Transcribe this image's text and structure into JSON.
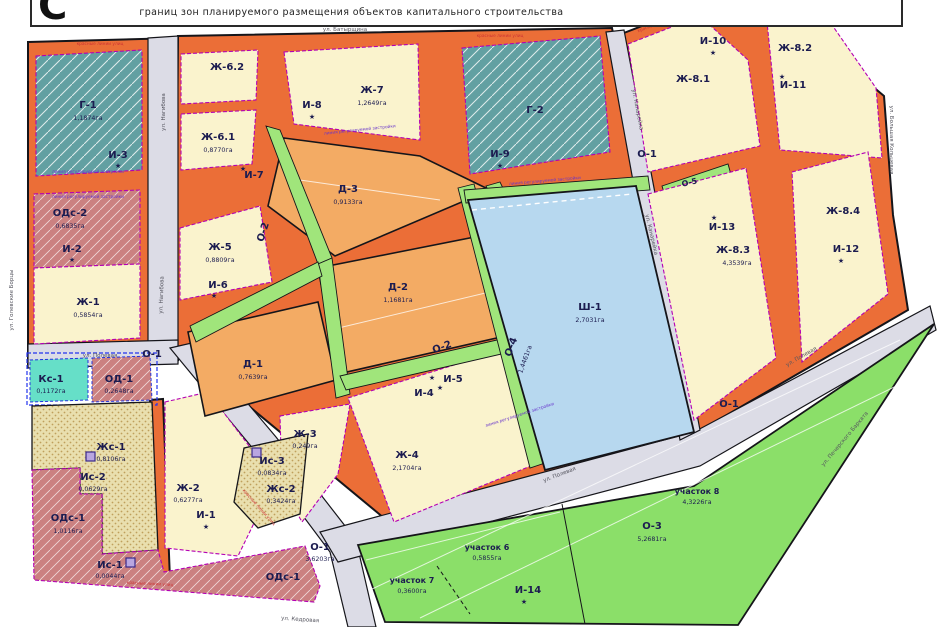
{
  "header": {
    "glyph": "С",
    "title": "границ зон планируемого размещения объектов капитального строительства"
  },
  "icons": {
    "star": "★"
  },
  "zones": {
    "g1": {
      "name": "Г-1",
      "area": "1,1874га"
    },
    "g2": {
      "name": "Г-2"
    },
    "i1": {
      "name": "И-1"
    },
    "i2": {
      "name": "И-2"
    },
    "i3": {
      "name": "И-3"
    },
    "i4": {
      "name": "И-4"
    },
    "i5": {
      "name": "И-5"
    },
    "i6": {
      "name": "И-6"
    },
    "i7": {
      "name": "И-7"
    },
    "i8": {
      "name": "И-8"
    },
    "i9": {
      "name": "И-9"
    },
    "i10": {
      "name": "И-10"
    },
    "i11": {
      "name": "И-11"
    },
    "i12": {
      "name": "И-12"
    },
    "i13": {
      "name": "И-13"
    },
    "i14": {
      "name": "И-14"
    },
    "ods2": {
      "name": "ОДс-2",
      "area": "0,6835га"
    },
    "ods1": {
      "name": "ОДс-1",
      "area": "1,0116га"
    },
    "od1": {
      "name": "ОД-1",
      "area": "0,2648га"
    },
    "ks1": {
      "name": "Кс-1",
      "area": "0,1172га"
    },
    "zh1": {
      "name": "Ж-1",
      "area": "0,5854га"
    },
    "zh2": {
      "name": "Ж-2",
      "area": "0,6277га"
    },
    "zh3": {
      "name": "Ж-3",
      "area": "0,249га"
    },
    "zh4": {
      "name": "Ж-4",
      "area": "2,1704га"
    },
    "zh5": {
      "name": "Ж-5",
      "area": "0,8809га"
    },
    "zh61": {
      "name": "Ж-6.1",
      "area": "0,8770га"
    },
    "zh62": {
      "name": "Ж-6.2"
    },
    "zh7": {
      "name": "Ж-7",
      "area": "1,2649га"
    },
    "zh81": {
      "name": "Ж-8.1"
    },
    "zh82": {
      "name": "Ж-8.2"
    },
    "zh83": {
      "name": "Ж-8.3",
      "area": "4,3539га"
    },
    "zh84": {
      "name": "Ж-8.4"
    },
    "zhs1": {
      "name": "Жс-1",
      "area": "0,8106га"
    },
    "zhs2": {
      "name": "Жс-2",
      "area": "0,3424га"
    },
    "is1": {
      "name": "Ис-1",
      "area": "0,0044га"
    },
    "is2": {
      "name": "Ис-2",
      "area": "0,0629га"
    },
    "is3": {
      "name": "Ис-3",
      "area": "0,0834га"
    },
    "d1": {
      "name": "Д-1",
      "area": "0,7639га"
    },
    "d2": {
      "name": "Д-2",
      "area": "1,1681га"
    },
    "d3": {
      "name": "Д-3",
      "area": "0,9133га"
    },
    "sh1": {
      "name": "Ш-1",
      "area": "2,7031га"
    },
    "o1": {
      "name": "О-1",
      "area": "3,6203га"
    },
    "o2": {
      "name": "О-2"
    },
    "o3": {
      "name": "О-3",
      "area": "5,2681га"
    },
    "o4": {
      "name": "О-4",
      "area": "1,4461га"
    },
    "o5": {
      "name": "О-5"
    },
    "uch6": {
      "name": "участок 6",
      "area": "0,5855га"
    },
    "uch7": {
      "name": "участок 7",
      "area": "0,3600га"
    },
    "uch8": {
      "name": "участок 8",
      "area": "4,3226га"
    }
  },
  "streets": {
    "batyrshina": "ул. Батырщина",
    "nagibova": "ул. Нагибова",
    "polevaya": "ул. Полевая",
    "golevskie": "ул. Голевские Борцы",
    "kanareika": "ул. Канарейка",
    "bolshaya_koltsevaya": "ул. Большая Кольцевая",
    "pecherskogo": "ул. Печерского Бархата",
    "kedrovaya": "ул. Кедровая"
  },
  "legend_lines": {
    "red": "красные линии улиц",
    "purple": "линия регулируемой застройки"
  },
  "colors": {
    "orange_corridor": "#eb6e37",
    "block_yellow": "#faf3cd",
    "teal": "#62a0a2",
    "rose": "#cb8181",
    "tan": "#f3ab64",
    "pond_blue": "#b7d8ef",
    "green_area": "#8bdf69",
    "green_strip": "#a0e57b",
    "street_gray": "#dcdce6",
    "aqua": "#66dfc8",
    "dot_beige": "#e9dfae",
    "magenta_dash": "#b400b4",
    "label_navy": "#1c1c50"
  }
}
